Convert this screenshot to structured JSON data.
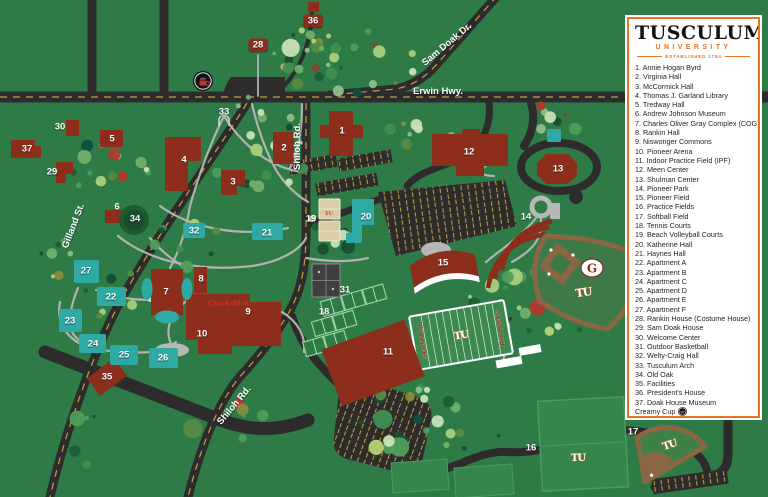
{
  "legend": {
    "title": "TUSCULUM",
    "subtitle": "UNIVERSITY",
    "established": "ESTABLISHED 1794",
    "items": [
      {
        "num": "1",
        "label": "Annie Hogan Byrd"
      },
      {
        "num": "2",
        "label": "Virginia Hall"
      },
      {
        "num": "3",
        "label": "McCormick Hall"
      },
      {
        "num": "4",
        "label": "Thomas J. Garland Library"
      },
      {
        "num": "5",
        "label": "Tredway Hall"
      },
      {
        "num": "6",
        "label": "Andrew Johnson Museum"
      },
      {
        "num": "7",
        "label": "Charles Oliver Gray Complex (COG)"
      },
      {
        "num": "8",
        "label": "Rankin Hall"
      },
      {
        "num": "9",
        "label": "Niswonger Commons"
      },
      {
        "num": "10",
        "label": "Pioneer Arena"
      },
      {
        "num": "11",
        "label": "Indoor Practice Field (IPF)"
      },
      {
        "num": "12",
        "label": "Meen Center"
      },
      {
        "num": "13",
        "label": "Shulman Center"
      },
      {
        "num": "14",
        "label": "Pioneer Park"
      },
      {
        "num": "15",
        "label": "Pioneer Field"
      },
      {
        "num": "16",
        "label": "Practice Fields"
      },
      {
        "num": "17",
        "label": "Softball Field"
      },
      {
        "num": "18",
        "label": "Tennis Courts"
      },
      {
        "num": "19",
        "label": "Beach Volleyball Courts"
      },
      {
        "num": "20",
        "label": "Katherine Hall"
      },
      {
        "num": "21",
        "label": "Haynes Hall"
      },
      {
        "num": "22",
        "label": "Apartment A"
      },
      {
        "num": "23",
        "label": "Apartment B"
      },
      {
        "num": "24",
        "label": "Apartment C"
      },
      {
        "num": "25",
        "label": "Apartment D"
      },
      {
        "num": "26",
        "label": "Apartment E"
      },
      {
        "num": "27",
        "label": "Apartment F"
      },
      {
        "num": "28",
        "label": "Rankin House (Costume House)"
      },
      {
        "num": "29",
        "label": "Sam Doak House"
      },
      {
        "num": "30",
        "label": "Welcome Center"
      },
      {
        "num": "31",
        "label": "Outdoor Basketball"
      },
      {
        "num": "32",
        "label": "Welty-Craig Hall"
      },
      {
        "num": "33",
        "label": "Tusculum Arch"
      },
      {
        "num": "34",
        "label": "Old Oak"
      },
      {
        "num": "35",
        "label": "Facilities"
      },
      {
        "num": "36",
        "label": "President's House"
      },
      {
        "num": "37",
        "label": "Doak House Museum"
      }
    ],
    "extras": [
      {
        "label": "Creamy Cup"
      },
      {
        "label": "Chick-fil-A",
        "logo_text": "Chick-fil-A"
      }
    ]
  },
  "roads": {
    "erwin": "Erwin Hwy.",
    "sam_doak": "Sam Doak Dr.",
    "shiloh": "Shiloh Rd.",
    "gilland": "Gilland St."
  },
  "logos": {
    "tu": "TU",
    "g": "G",
    "pioneers": "Pioneers",
    "chick_fil_a_script": "Chick-fil-A"
  },
  "colors": {
    "background_green": "#2e7b47",
    "building_maroon": "#8d2e1c",
    "residence_teal": "#2fa9a3",
    "legend_orange": "#e87322",
    "road_dark": "#2d2c2a",
    "chick_fil_a_red": "#c8342b"
  },
  "map_markers": [
    {
      "num": "1",
      "x": 342,
      "y": 131
    },
    {
      "num": "2",
      "x": 284,
      "y": 148
    },
    {
      "num": "3",
      "x": 233,
      "y": 182
    },
    {
      "num": "4",
      "x": 184,
      "y": 160
    },
    {
      "num": "5",
      "x": 112,
      "y": 139
    },
    {
      "num": "6",
      "x": 117,
      "y": 207
    },
    {
      "num": "7",
      "x": 166,
      "y": 292
    },
    {
      "num": "8",
      "x": 201,
      "y": 279
    },
    {
      "num": "9",
      "x": 248,
      "y": 312
    },
    {
      "num": "10",
      "x": 202,
      "y": 334
    },
    {
      "num": "11",
      "x": 388,
      "y": 352
    },
    {
      "num": "12",
      "x": 469,
      "y": 152
    },
    {
      "num": "13",
      "x": 558,
      "y": 169
    },
    {
      "num": "14",
      "x": 526,
      "y": 217
    },
    {
      "num": "15",
      "x": 443,
      "y": 263
    },
    {
      "num": "16",
      "x": 531,
      "y": 448
    },
    {
      "num": "17",
      "x": 633,
      "y": 432
    },
    {
      "num": "18",
      "x": 324,
      "y": 312
    },
    {
      "num": "19",
      "x": 311,
      "y": 219
    },
    {
      "num": "20",
      "x": 366,
      "y": 217
    },
    {
      "num": "21",
      "x": 267,
      "y": 233
    },
    {
      "num": "22",
      "x": 111,
      "y": 297
    },
    {
      "num": "23",
      "x": 70,
      "y": 321
    },
    {
      "num": "24",
      "x": 93,
      "y": 344
    },
    {
      "num": "25",
      "x": 124,
      "y": 355
    },
    {
      "num": "26",
      "x": 163,
      "y": 358
    },
    {
      "num": "27",
      "x": 86,
      "y": 271
    },
    {
      "num": "28",
      "x": 258,
      "y": 45,
      "boxed": true
    },
    {
      "num": "29",
      "x": 52,
      "y": 172
    },
    {
      "num": "30",
      "x": 60,
      "y": 127
    },
    {
      "num": "31",
      "x": 345,
      "y": 290
    },
    {
      "num": "32",
      "x": 194,
      "y": 231
    },
    {
      "num": "33",
      "x": 224,
      "y": 112
    },
    {
      "num": "34",
      "x": 135,
      "y": 219
    },
    {
      "num": "35",
      "x": 107,
      "y": 377
    },
    {
      "num": "36",
      "x": 313,
      "y": 21,
      "boxed": true
    },
    {
      "num": "37",
      "x": 27,
      "y": 149
    }
  ]
}
